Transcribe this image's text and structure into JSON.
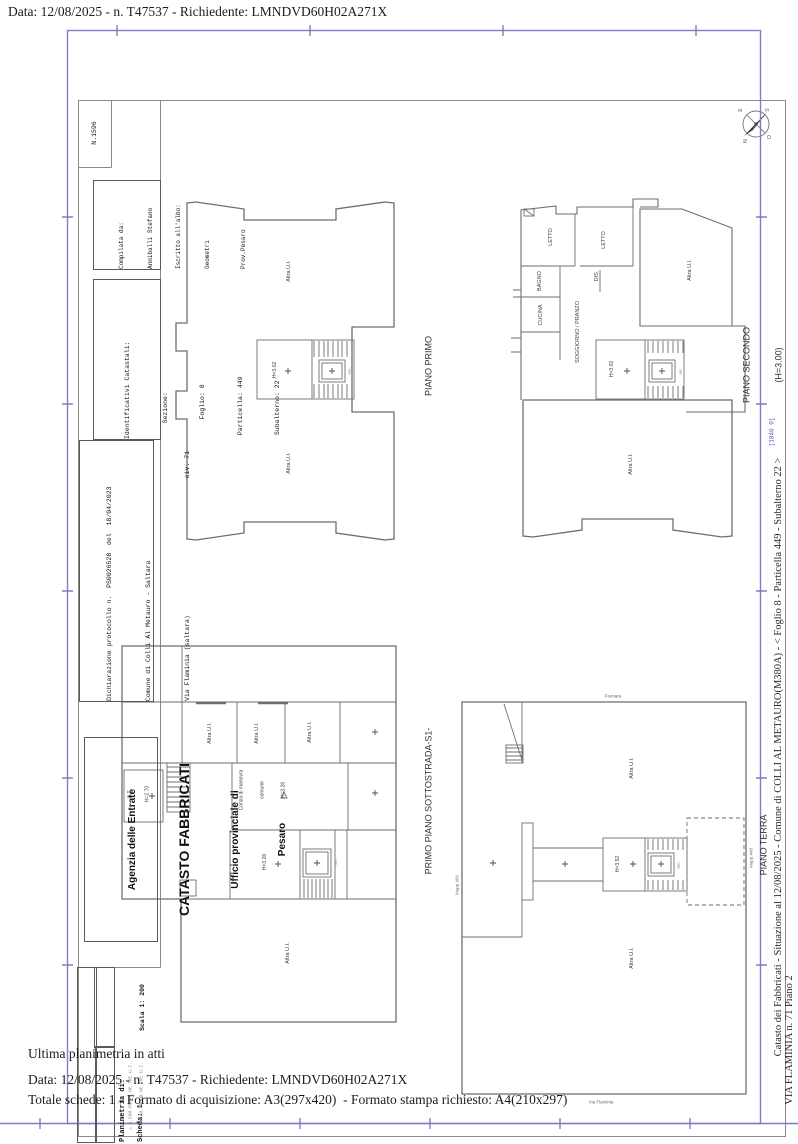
{
  "page": {
    "header_line": "Data: 12/08/2025 - n. T47537 - Richiedente: LMNDVD60H02A271X",
    "footer": {
      "ultima": "Ultima planimetria in atti",
      "data_line": "Data: 12/08/2025 - n. T47537 - Richiedente: LMNDVD60H02A271X",
      "totale_line": "Totale schede: 1 - Formato di acquisizione: A3(297x420)  - Formato stampa richiesto: A4(210x297)"
    }
  },
  "right_margin": {
    "line1": "Catasto dei Fabbricati - Situazione al 12/08/2025 - Comune di COLLI AL METAURO(M380A) - < Foglio 8 - Particella 449 - Subalterno 22 >",
    "line2": "VIA FLAMINIA n. 71 Piano 2",
    "stamp": "[1840 0]"
  },
  "title_block": {
    "numero": "N.1596",
    "compilata": [
      "Compilata da:",
      "Anniballi Stefano",
      "Iscritto all'albo:",
      "Geometri",
      "Prov.Pesaro"
    ],
    "identificativi": [
      "Identificativi Catastali:",
      "    Sezione:",
      "     Foglio: 8",
      " Particella: 449",
      " Subalterno: 22"
    ],
    "dichiarazione": [
      "Dichiarazione protocollo n.  PS0026528  del  18/04/2023",
      "Comune di Colli Al Metauro - Saltara",
      "Via Flaminia (saltara)",
      "civ. 71"
    ],
    "agenzia": [
      "Agenzia delle Entrate",
      "CATASTO FABBRICATI",
      "Ufficio provinciale di",
      "Pesaro"
    ],
    "scala": "Scala 1: 200",
    "planimetria": "Planimetria di:",
    "scheda": "Scheda: 1",
    "legend": [
      "△ N.COM.PROPR.NE TRE U.I.",
      "+ N.COM.PROPR.NE TRE U.I."
    ]
  },
  "compass": {
    "n": "N",
    "s": "S",
    "e": "E",
    "o": "O"
  },
  "plans": {
    "primo": {
      "title": "PIANO PRIMO",
      "altra_top": "Altra U.I.",
      "altra_bottom": "Altra U.I.",
      "h": "H=3.02",
      "asc": "asc."
    },
    "secondo": {
      "title": "PIANO SECONDO",
      "subtitle": "(H=3.00)",
      "letto1": "LETTO",
      "letto2": "LETTO",
      "bagno": "BAGNO",
      "dis": "DIS.",
      "cucina": "CUCINA",
      "soggiorno": "SOGGIORNO / PRANZO",
      "altra_right": "Altra U.I.",
      "altra_bottom": "Altra U.I.",
      "h": "H=3.02",
      "asc": "asc."
    },
    "sottostrada": {
      "title": "PRIMO PIANO SOTTOSTRADA-S1-",
      "altra1": "Altra U.I.",
      "altra2": "Altra U.I.",
      "altra3": "Altra U.I.",
      "altra_bottom": "Altra U.I.",
      "ct": "C.T.",
      "ct_h": "H=2.70",
      "corsia1": "Corsia di manovra",
      "corsia2": "comune",
      "corsia3": "H=3.26",
      "h": "H=3.26",
      "asc": "asc."
    },
    "terra": {
      "title": "PIANO TERRA",
      "altra_top": "Altra U.I.",
      "altra_bottom": "Altra U.I.",
      "h": "H=3.52",
      "mapp_left": "Mapp.460",
      "mapp_right": "Mapp.448",
      "top_label": "Fiumara",
      "bottom_label": "Via Flaminia",
      "asc": "asc."
    }
  }
}
